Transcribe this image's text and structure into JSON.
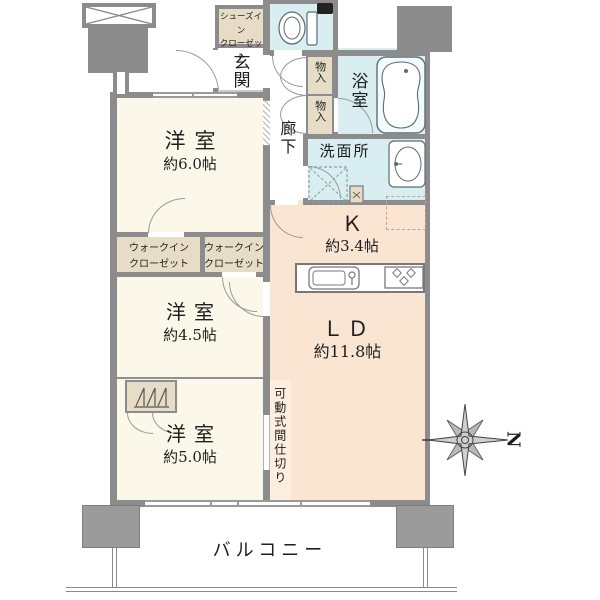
{
  "colors": {
    "wall": "#8c8c8c",
    "bedroom_cream": "#fbf8ea",
    "closet_beige": "#e7ddc7",
    "wet_area_cyan": "#d9eef0",
    "living_peach": "#f9e5d2",
    "partition_peach": "#fdeedf",
    "text": "#1e1e1e"
  },
  "plan": {
    "bedroom1": {
      "name": "洋室",
      "size": "約6.0帖"
    },
    "bedroom2": {
      "name": "洋室",
      "size": "約4.5帖"
    },
    "bedroom3": {
      "name": "洋室",
      "size": "約5.0帖"
    },
    "living_dining": {
      "name": "ＬＤ",
      "size": "約11.8帖"
    },
    "kitchen": {
      "name": "Ｋ",
      "size": "約3.4帖"
    },
    "entrance": {
      "name": "玄関"
    },
    "hallway": {
      "name": "廊下"
    },
    "bathroom": {
      "name": "浴室"
    },
    "washroom": {
      "name": "洗面所"
    },
    "storage1": {
      "name": "物入"
    },
    "storage2": {
      "name": "物入"
    },
    "shoes_closet": {
      "name": "シューズイン\nクローゼット"
    },
    "walk_in_closet1": {
      "name": "ウォークイン\nクローゼット"
    },
    "walk_in_closet2": {
      "name": "ウォークイン\nクローゼット"
    },
    "movable_partition": {
      "name": "可動式間仕切り"
    },
    "balcony": {
      "name": "バルコニー"
    },
    "compass_n": "N"
  }
}
